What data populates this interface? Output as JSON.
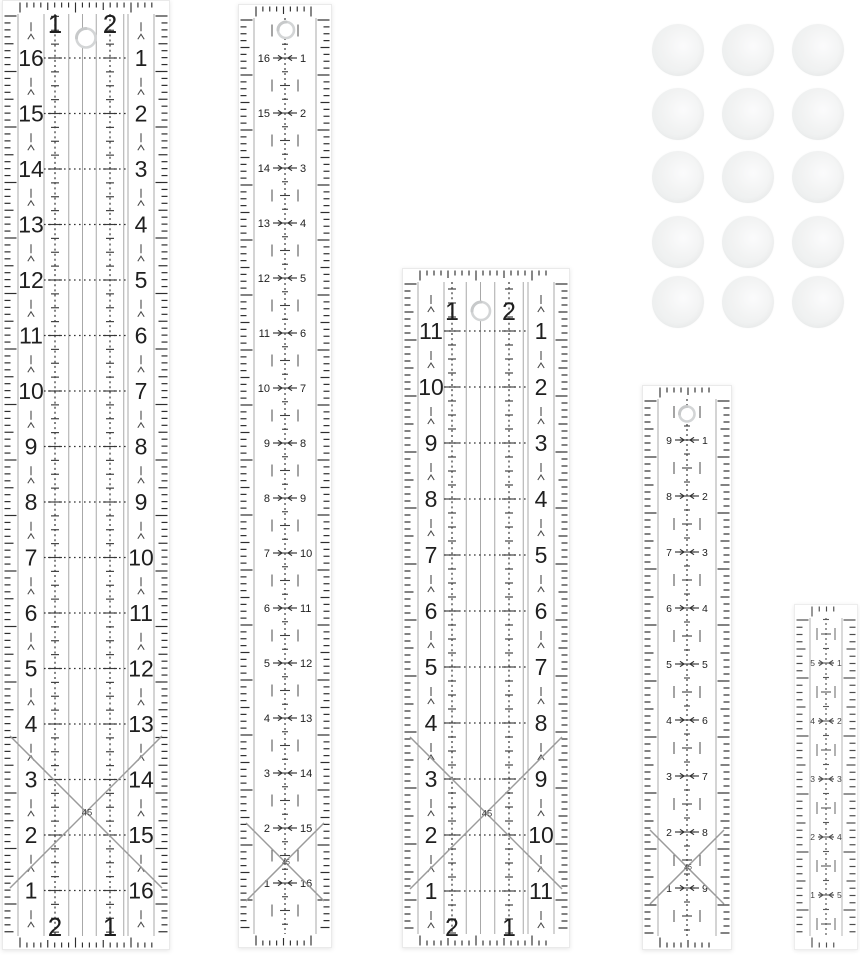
{
  "scene": {
    "width": 860,
    "height": 960,
    "background": "#ffffff",
    "description": "acrylic quilting ruler set with sewing snap clips"
  },
  "colors": {
    "ink": "#1f1f1f",
    "tick": "#2e2e2e",
    "grid": "#a8a8a8",
    "dash": "#3c3c3c",
    "row_dot": "#333333",
    "cross": "#9b9b9b",
    "cross_label": "#444444",
    "hole_ring": "#d3d5d6",
    "hole_shade": "#c7c9ca",
    "body_edge": "#eaeaea",
    "half_mark": "#4a4a4a",
    "arrow": "#333333"
  },
  "rulers": [
    {
      "id": "ruler-1-large-grid",
      "type": "wide",
      "x": 2,
      "y": 0,
      "w": 168,
      "h": 950,
      "unit": 55.5,
      "first_row": 58,
      "left_numbers": [
        "16",
        "15",
        "14",
        "13",
        "12",
        "11",
        "10",
        "9",
        "8",
        "7",
        "6",
        "5",
        "4",
        "3",
        "2",
        "1"
      ],
      "right_numbers": [
        "1",
        "2",
        "3",
        "4",
        "5",
        "6",
        "7",
        "8",
        "9",
        "10",
        "11",
        "12",
        "13",
        "14",
        "15",
        "16"
      ],
      "top_labels": [
        "1",
        "2"
      ],
      "bottom_labels": [
        "2",
        "1"
      ],
      "label_xs": [
        53,
        108
      ],
      "top_baseline": 33,
      "bottom_baseline": 936,
      "num_font": 23,
      "label_font": 26,
      "hole": {
        "x": 84,
        "y": 38,
        "r": 9.5
      },
      "cross": {
        "cy": 812,
        "label": "45",
        "font": 9.5
      },
      "opacity": 1
    },
    {
      "id": "ruler-2-narrow-16",
      "type": "narrow",
      "x": 238,
      "y": 4,
      "w": 94,
      "h": 944,
      "unit": 55,
      "first_row": 54,
      "left_numbers": [
        "16",
        "15",
        "14",
        "13",
        "12",
        "11",
        "10",
        "9",
        "8",
        "7",
        "6",
        "5",
        "4",
        "3",
        "2",
        "1"
      ],
      "right_numbers": [
        "1",
        "2",
        "3",
        "4",
        "5",
        "6",
        "7",
        "8",
        "9",
        "10",
        "11",
        "12",
        "13",
        "14",
        "15",
        "16"
      ],
      "num_font": 11,
      "hole": {
        "x": 48,
        "y": 26,
        "r": 8
      },
      "cross": {
        "cy": 858,
        "label": "45",
        "font": 7
      },
      "opacity": 1
    },
    {
      "id": "ruler-3-medium-grid",
      "type": "wide",
      "x": 402,
      "y": 268,
      "w": 168,
      "h": 680,
      "unit": 56,
      "first_row": 63,
      "left_numbers": [
        "11",
        "10",
        "9",
        "8",
        "7",
        "6",
        "5",
        "4",
        "3",
        "2",
        "1"
      ],
      "right_numbers": [
        "1",
        "2",
        "3",
        "4",
        "5",
        "6",
        "7",
        "8",
        "9",
        "10",
        "11"
      ],
      "top_labels": [
        "1",
        "2"
      ],
      "bottom_labels": [
        "2",
        "1"
      ],
      "label_xs": [
        50,
        107
      ],
      "top_baseline": 52,
      "bottom_baseline": 668,
      "num_font": 23,
      "label_font": 25,
      "hole": {
        "x": 79,
        "y": 43,
        "r": 9
      },
      "cross": {
        "cy": 545,
        "label": "45",
        "font": 9.5
      },
      "opacity": 1
    },
    {
      "id": "ruler-4-narrow-9",
      "type": "narrow",
      "x": 642,
      "y": 385,
      "w": 90,
      "h": 565,
      "unit": 56,
      "first_row": 55,
      "left_numbers": [
        "9",
        "8",
        "7",
        "6",
        "5",
        "4",
        "3",
        "2",
        "1"
      ],
      "right_numbers": [
        "1",
        "2",
        "3",
        "4",
        "5",
        "6",
        "7",
        "8",
        "9"
      ],
      "num_font": 10.5,
      "hole": {
        "x": 45,
        "y": 29,
        "r": 7.5
      },
      "cross": {
        "cy": 482,
        "label": "45",
        "font": 7
      },
      "opacity": 1
    },
    {
      "id": "ruler-5-mini-5",
      "type": "narrow",
      "x": 794,
      "y": 604,
      "w": 64,
      "h": 346,
      "unit": 58,
      "first_row": 59,
      "left_numbers": [
        "5",
        "4",
        "3",
        "2",
        "1"
      ],
      "right_numbers": [
        "1",
        "2",
        "3",
        "4",
        "5"
      ],
      "num_font": 8.5,
      "hole": null,
      "cross": null,
      "opacity": 0.85
    }
  ],
  "discs": {
    "count": 15,
    "cols_x": [
      678,
      748,
      818
    ],
    "rows_y": [
      50,
      114,
      177,
      242,
      302
    ],
    "radius": 26
  }
}
